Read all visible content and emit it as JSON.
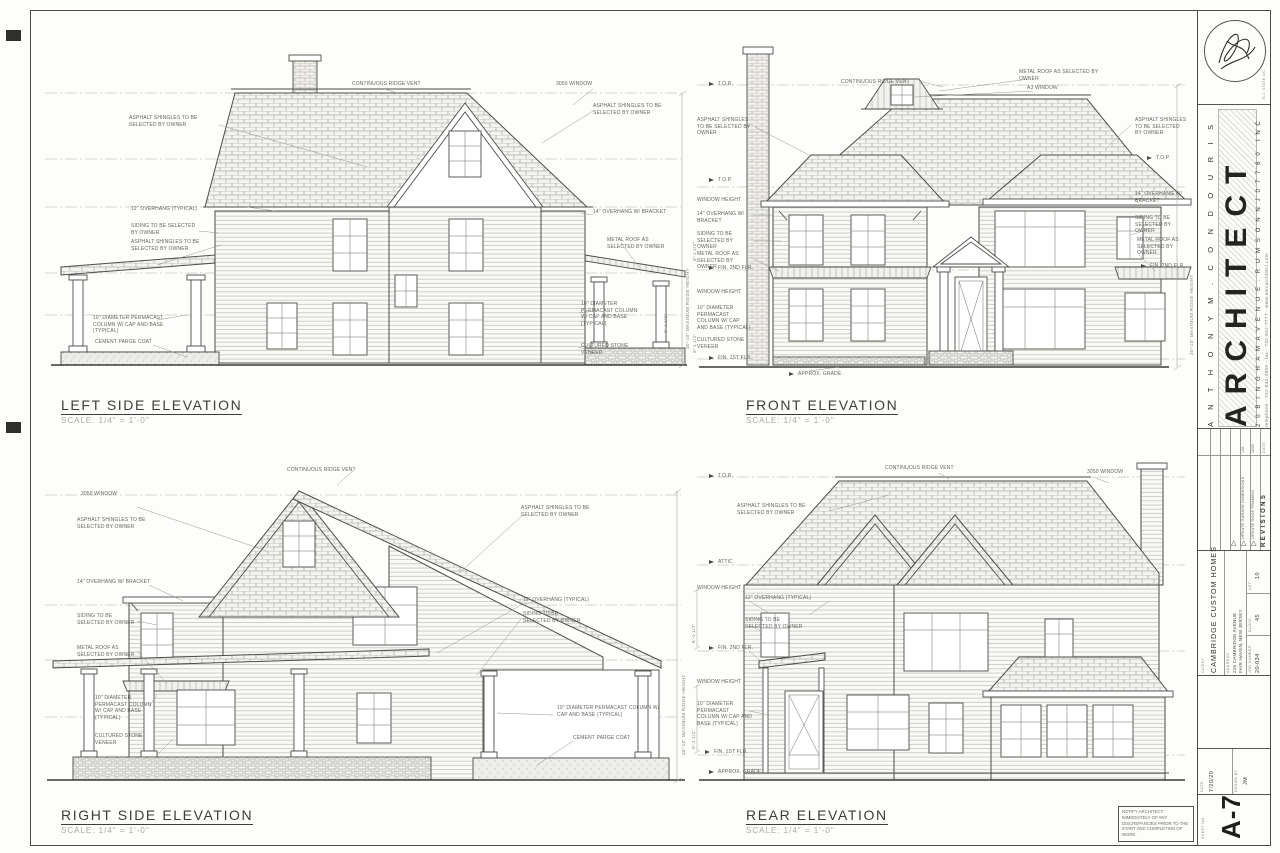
{
  "sheet": {
    "note": "NOTIFY ARCHITECT IMMEDIATELY OF ANY DISCREPANCIES PRIOR TO THE START AND COMPLETION OF WORK.",
    "paper_color": "#fdfdfb",
    "line_color": "#4a4a46"
  },
  "title_block": {
    "license": "N.J. STATE LIC.",
    "firm_name": "A N T H O N Y   M .   C O N D O U R I S",
    "firm_title": "ARCHITECT",
    "firm_suffix": "I N C",
    "firm_address": "2 0   B I N G H A M   A V E N U E .   R U M S O N   N J   0 7 7 6 0",
    "firm_contact": "telephone - 732-842-3800 - fax - 732-842-7777 - www.amcarchitect.com",
    "revisions": {
      "heading": "REVISIONS",
      "date_heading": "DATE",
      "marker": "△",
      "rows": [
        {
          "text": "UPDATE ROOF FRAMING",
          "date": "10/20"
        },
        {
          "text": "UPDATE GARAGE DIMENSIONS",
          "date": "1/21"
        }
      ]
    },
    "client_label": "CLIENT",
    "client_name": "CAMBRIDGE CUSTOM HOMES",
    "address_label": "ADDRESS",
    "address_line1": "225 CAMBRIDGE AVENUE",
    "address_line2": "FAIR HAVEN, NEW JERSEY",
    "job_label": "JOB NUMBER",
    "job_value": "20-034",
    "block_label": "BLOCK",
    "block_value": "45",
    "lot_label": "LOT",
    "lot_value": "10",
    "date_label": "DATE",
    "date_value": "7/20/20",
    "drawn_label": "DRAWN BY",
    "drawn_value": "JM",
    "sheet_label": "SHEET NO.",
    "sheet_number": "A-7"
  },
  "elevations": {
    "left_side": {
      "title": "LEFT SIDE ELEVATION",
      "scale": "SCALE: 1/4\" = 1'-0\"",
      "labels": {
        "ridge_vent": "CONTINUOUS RIDGE VENT",
        "window_3050": "3050 WINDOW",
        "shingles_upper": "ASPHALT SHINGLES TO BE SELECTED BY OWNER",
        "overhang_12": "12\" OVERHANG (TYPICAL)",
        "siding": "SIDING TO BE SELECTED BY OWNER",
        "shingles_porch": "ASPHALT SHINGLES TO BE SELECTED BY OWNER",
        "column": "10\" DIAMETER PERMACAST COLUMN W/ CAP AND BASE (TYPICAL)",
        "parge": "CEMENT PARGE COAT",
        "shingles_right": "ASPHALT SHINGLES TO BE SELECTED BY OWNER",
        "overhang_14": "14\" OVERHANG W/ BRACKET",
        "metal_roof": "METAL ROOF AS SELECTED BY OWNER",
        "column_right": "10\" DIAMETER PERMACAST COLUMN W/ CAP AND BASE (TYPICAL)",
        "stone": "CULTURED STONE VENEER",
        "ridge_height": "30'-10\" MAXIMUM RIDGE HEIGHT"
      },
      "dims": {
        "porch": "9'-1 1/2\""
      }
    },
    "front": {
      "title": "FRONT ELEVATION",
      "scale": "SCALE: 1/4\" = 1'-0\"",
      "labels": {
        "ridge_vent": "CONTINUOUS RIDGE VENT",
        "tor": "T.O.R.",
        "top_left": "T.O.P.",
        "top_right": "T.O.P.",
        "shingles_left": "ASPHALT SHINGLES TO BE SELECTED BY OWNER",
        "window_height_upper": "WINDOW HEIGHT",
        "window_height_lower": "WINDOW HEIGHT",
        "overhang_14_left": "14\" OVERHANG W/ BRACKET",
        "siding_left": "SIDING TO BE SELECTED BY OWNER",
        "metal_roof_left": "METAL ROOF AS SELECTED BY OWNER",
        "fin_2nd_left": "FIN. 2ND FLR.",
        "fin_1st": "FIN. 1ST FLR.",
        "column": "10\" DIAMETER PERMACAST COLUMN W/ CAP AND BASE (TYPICAL)",
        "stone": "CULTURED STONE VENEER",
        "metal_roof_dormer": "METAL ROOF AS SELECTED BY OWNER",
        "dormer_window": "A3 WINDOW",
        "shingles_right": "ASPHALT SHINGLES TO BE SELECTED BY OWNER",
        "overhang_14_right": "14\" OVERHANG W/ BRACKET",
        "siding_right": "SIDING TO BE SELECTED BY OWNER",
        "metal_roof_right": "METAL ROOF AS SELECTED BY OWNER",
        "fin_2nd_right": "FIN. 2ND FLR.",
        "approx_grade": "APPROX. GRADE",
        "ridge_height": "30'-10\" MAXIMUM RIDGE HEIGHT"
      },
      "dims": {
        "upper": "8'-1 1/2\"",
        "lower": "9'-1 1/2\""
      }
    },
    "right_side": {
      "title": "RIGHT SIDE ELEVATION",
      "scale": "SCALE: 1/4\" = 1'-0\"",
      "labels": {
        "ridge_vent": "CONTINUOUS RIDGE VENT",
        "window_3050": "3050 WINDOW",
        "shingles_left": "ASPHALT SHINGLES TO BE SELECTED BY OWNER",
        "overhang_14": "14\" OVERHANG W/ BRACKET",
        "siding_left": "SIDING TO BE SELECTED BY OWNER",
        "metal_roof": "METAL ROOF AS SELECTED BY OWNER",
        "column_left": "10\" DIAMETER PERMACAST COLUMN W/ CAP AND BASE (TYPICAL)",
        "stone_left": "CULTURED STONE VENEER",
        "shingles_right": "ASPHALT SHINGLES TO BE SELECTED BY OWNER",
        "overhang_12": "12\" OVERHANG (TYPICAL)",
        "siding_right": "SIDING TO BE SELECTED BY OWNER",
        "column_right": "10\" DIAMETER PERMACAST COLUMN W/ CAP AND BASE (TYPICAL)",
        "parge": "CEMENT PARGE COAT",
        "ridge_height": "30'-10\" MAXIMUM RIDGE HEIGHT"
      }
    },
    "rear": {
      "title": "REAR ELEVATION",
      "scale": "SCALE: 1/4\" = 1'-0\"",
      "labels": {
        "ridge_vent": "CONTINUOUS RIDGE VENT",
        "window_3050": "3050 WINDOW",
        "tor": "T.O.R.",
        "attic": "ATTIC",
        "shingles": "ASPHALT SHINGLES TO BE SELECTED BY OWNER",
        "window_height_upper": "WINDOW HEIGHT",
        "overhang_12": "12\" OVERHANG (TYPICAL)",
        "siding": "SIDING TO BE SELECTED BY OWNER",
        "fin_2nd": "FIN. 2ND FLR.",
        "window_height_lower": "WINDOW HEIGHT",
        "column": "10\" DIAMETER PERMACAST COLUMN W/ CAP AND BASE (TYPICAL)",
        "fin_1st": "FIN. 1ST FLR.",
        "approx_grade": "APPROX. GRADE"
      },
      "dims": {
        "upper": "8'-1 1/2\"",
        "lower": "9'-1 1/2\""
      }
    }
  }
}
